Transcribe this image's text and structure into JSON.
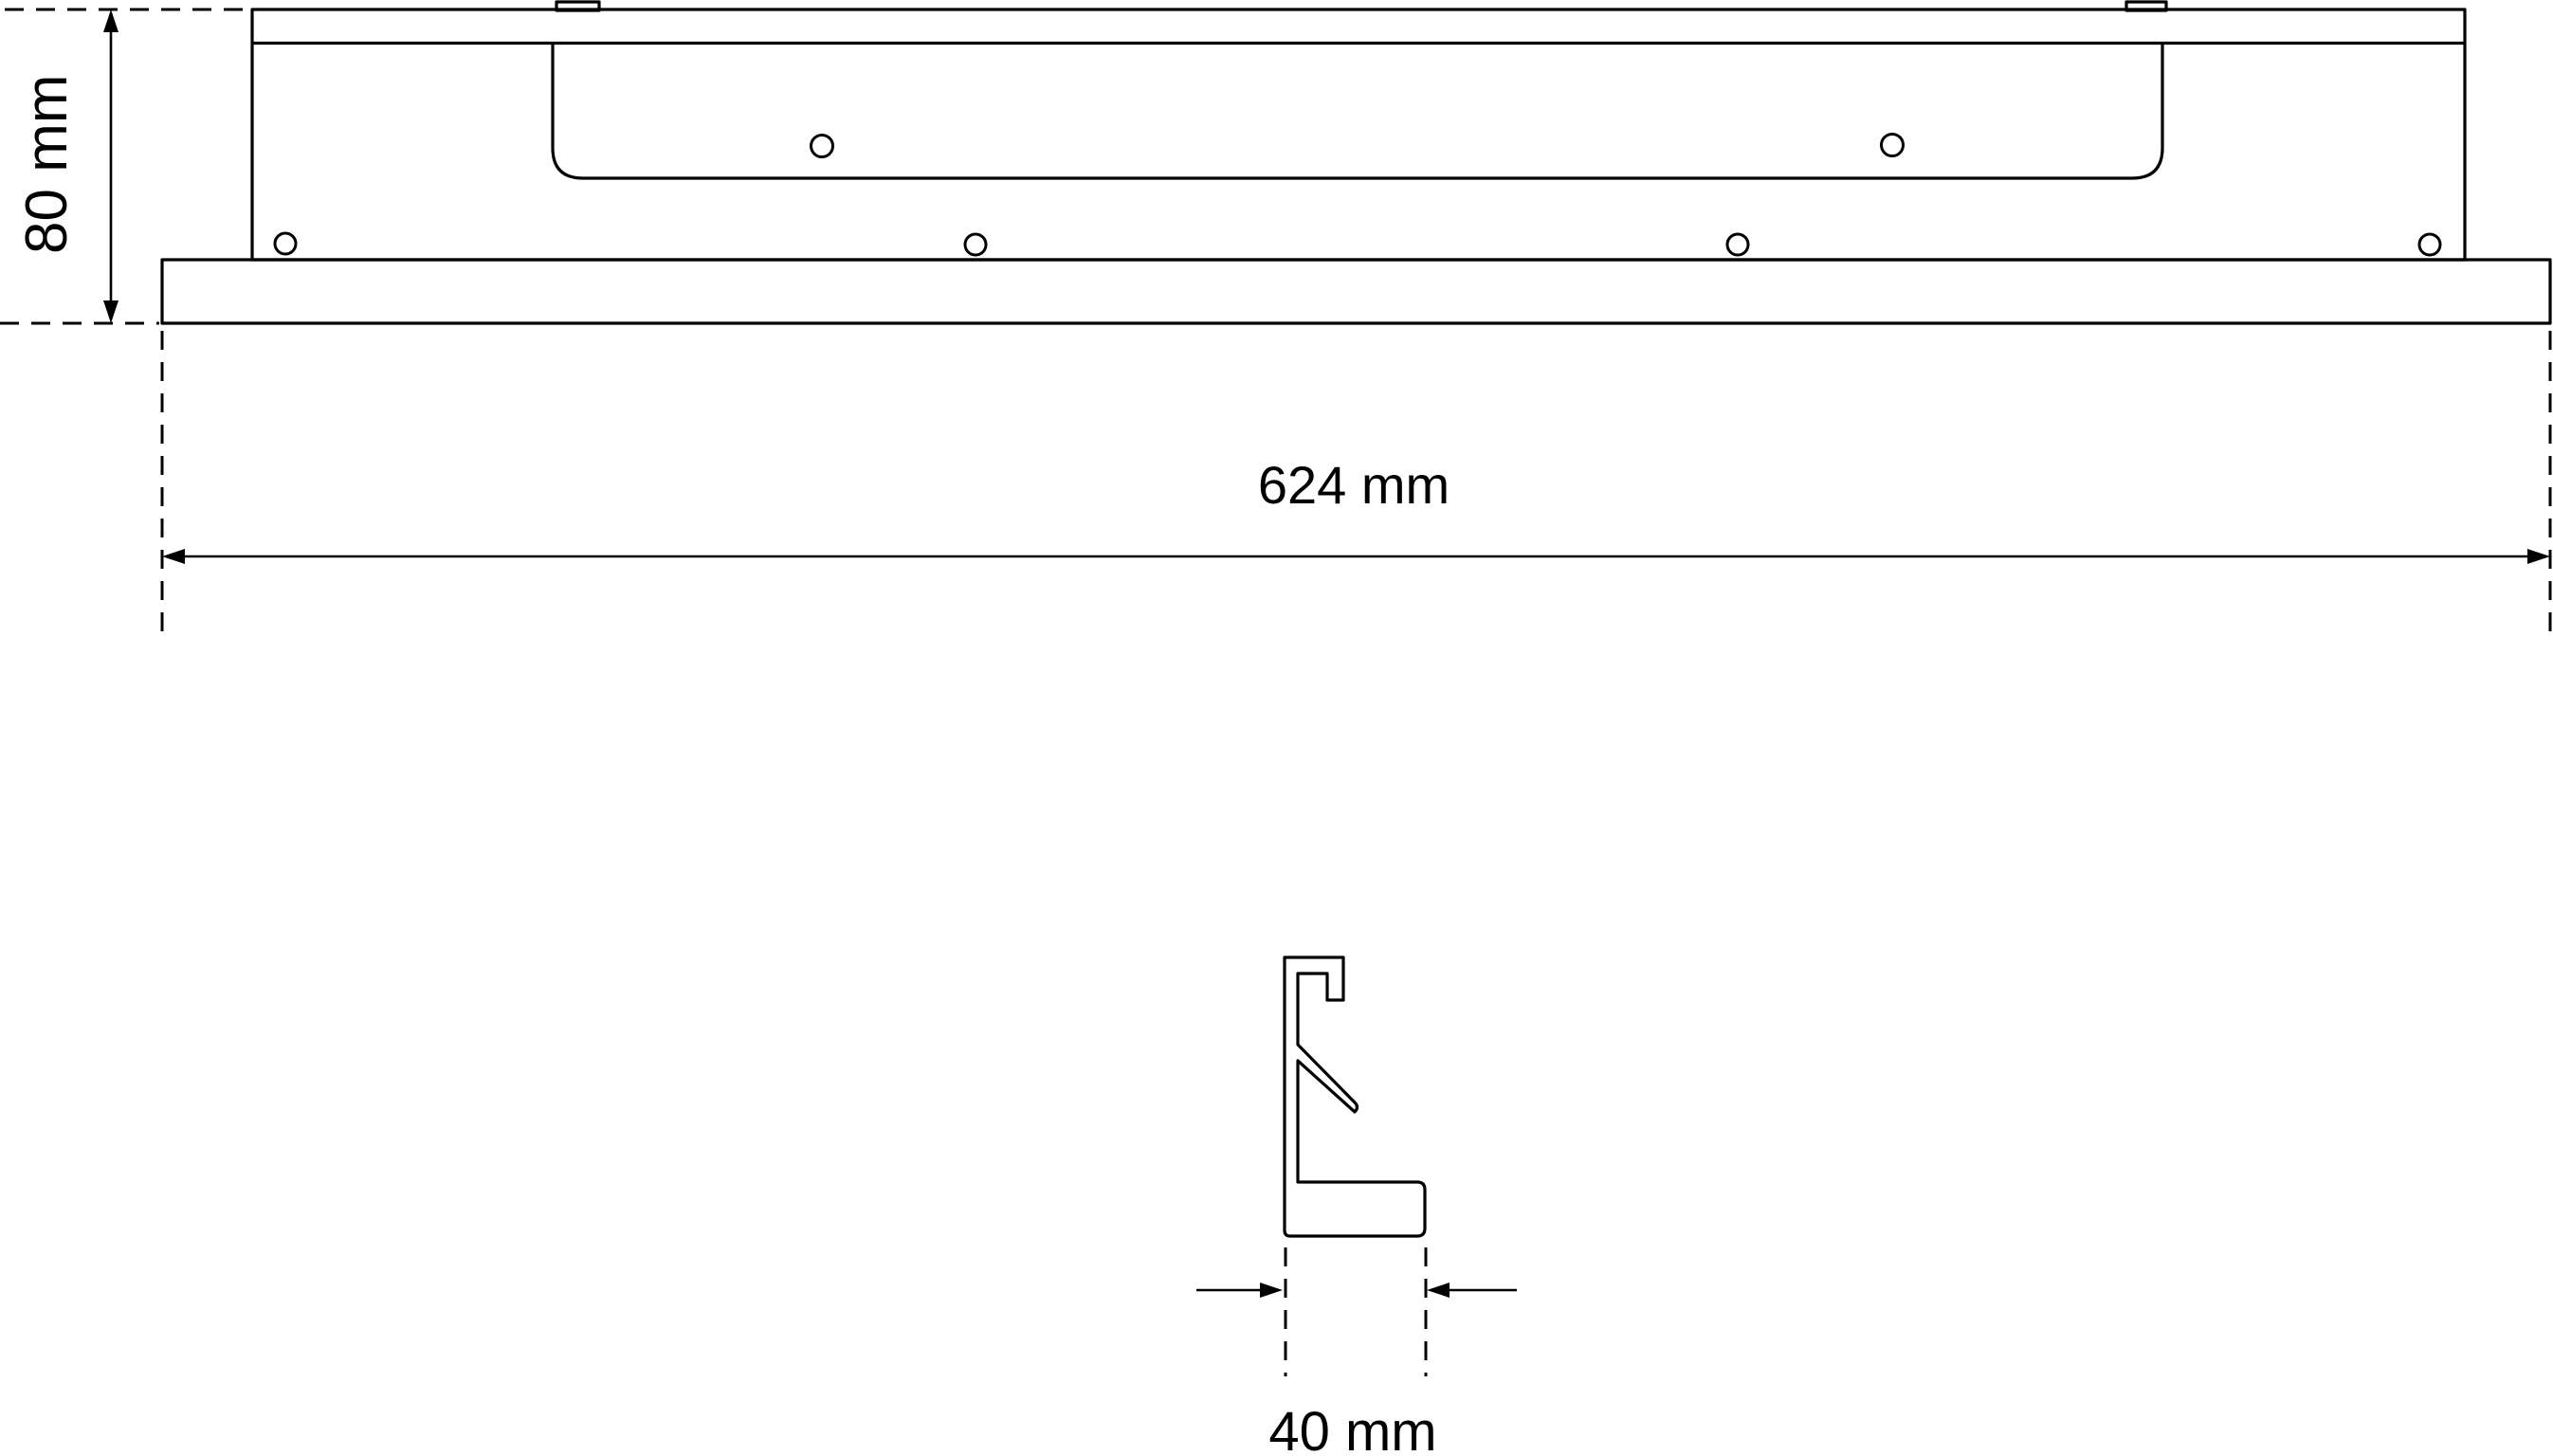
{
  "drawing": {
    "kind": "technical-dimension-drawing",
    "style": {
      "background_color": "#ffffff",
      "line_color": "#000000",
      "text_color": "#000000"
    },
    "labels": {
      "height": "80 mm",
      "width": "624 mm",
      "profile_width": "40 mm"
    },
    "front_view": {
      "mounting_tabs": 2,
      "recess_holes": 2,
      "body_holes": 4
    },
    "profile_view": {
      "features": "hook top, diagonal spring clip, L-shaped foot"
    }
  }
}
